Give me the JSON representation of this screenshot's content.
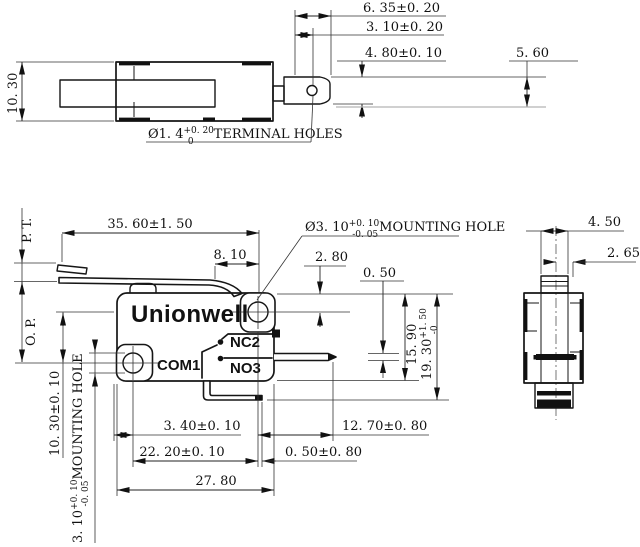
{
  "title": "Micro switch long lever technical drawing",
  "brand": "Unionwell",
  "top_view": {
    "body_depth": "10. 30",
    "dim_a": "6. 35±0. 20",
    "dim_b": "3. 10±0. 20",
    "dim_c": "4. 80±0. 10",
    "dim_d": "5. 60",
    "hole_dia": "Ø1. 4",
    "hole_tol_plus": "+0. 20",
    "hole_tol_minus": "0",
    "hole_label": "TERMINAL HOLES"
  },
  "front_view": {
    "lever_length": "35. 60±1. 50",
    "dim_8_10": "8. 10",
    "mount_hole_dia": "Ø3. 10",
    "mount_hole_tol_plus": "+0. 10",
    "mount_hole_tol_minus": "-0. 05",
    "mount_hole_label": "MOUNTING HOLE",
    "dim_2_80": "2. 80",
    "dim_0_50": "0. 50",
    "pt_label": "P. T.",
    "op_label": "O. P.",
    "logo": "Unionwell",
    "nc_label": "NC2",
    "com_label": "COM1",
    "no_label": "NO3",
    "dim_15_90": "15. 90",
    "dim_19_30": "19. 30",
    "dim_19_30_tol_plus": "+1. 50",
    "dim_19_30_tol_minus": "-0",
    "dim_10_30": "10. 30±0. 10",
    "left_hole_dia": "3. 10",
    "left_hole_tol_plus": "+0. 10",
    "left_hole_tol_minus": "-0. 05",
    "left_hole_label": "MOUNTING HOLE",
    "dim_3_40": "3. 40±0. 10",
    "dim_22_20": "22. 20±0. 10",
    "dim_27_80": "27. 80",
    "dim_12_70": "12. 70±0. 80",
    "dim_0_50b": "0. 50±0. 80"
  },
  "side_view": {
    "dim_4_50": "4. 50",
    "dim_2_65": "2. 65"
  }
}
